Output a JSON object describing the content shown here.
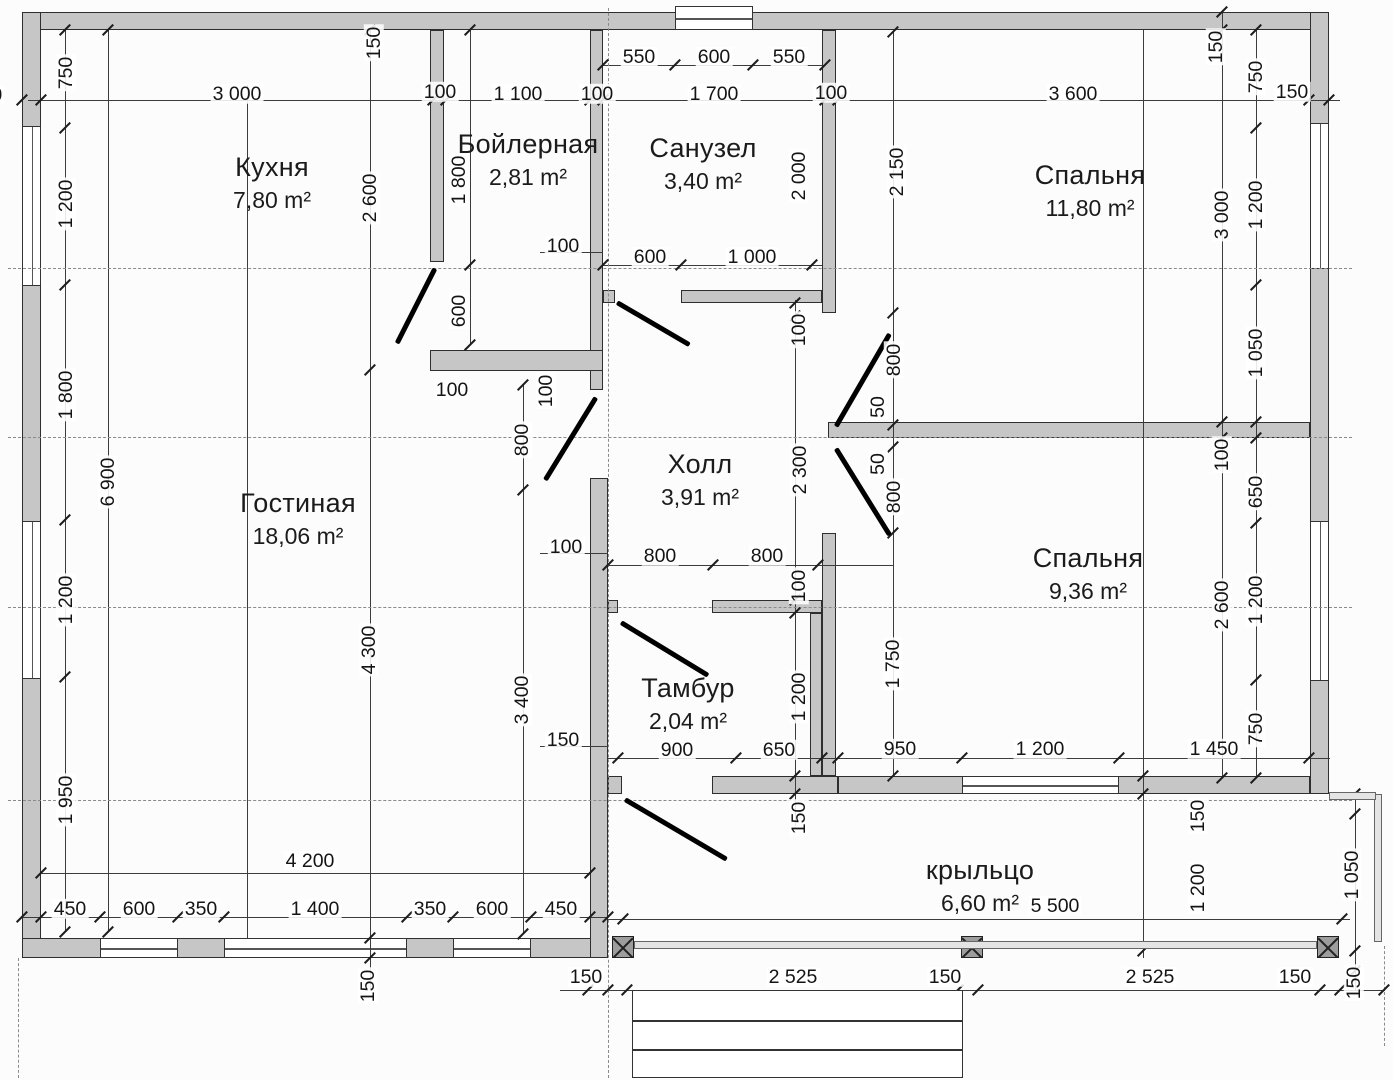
{
  "title": "План этажа (floor plan)",
  "colors": {
    "wall_fill": "#c6c6c6",
    "line": "#3c3c3c",
    "door": "#000000",
    "background": "#fcfcfc"
  },
  "rooms": [
    {
      "name": "Кухня",
      "area": "7,80 m²",
      "cx": 272,
      "cy": 183
    },
    {
      "name": "Бойлерная",
      "area": "2,81 m²",
      "cx": 528,
      "cy": 160
    },
    {
      "name": "Санузел",
      "area": "3,40 m²",
      "cx": 703,
      "cy": 164
    },
    {
      "name": "Спальня",
      "area": "11,80 m²",
      "cx": 1090,
      "cy": 191
    },
    {
      "name": "Гостиная",
      "area": "18,06 m²",
      "cx": 298,
      "cy": 519
    },
    {
      "name": "Холл",
      "area": "3,91 m²",
      "cx": 700,
      "cy": 480
    },
    {
      "name": "Спальня",
      "area": "9,36 m²",
      "cx": 1088,
      "cy": 574
    },
    {
      "name": "Тамбур",
      "area": "2,04 m²",
      "cx": 688,
      "cy": 704
    },
    {
      "name": "крыльцо",
      "area": "6,60 m²",
      "cx": 980,
      "cy": 886
    }
  ],
  "dimensions": [
    {
      "t": "150",
      "x": -14,
      "y": 95,
      "v": 0
    },
    {
      "t": "750",
      "x": 66,
      "y": 73,
      "v": 1
    },
    {
      "t": "3 000",
      "x": 237,
      "y": 94,
      "v": 0
    },
    {
      "t": "100",
      "x": 440,
      "y": 92,
      "v": 0
    },
    {
      "t": "1 100",
      "x": 518,
      "y": 94,
      "v": 0
    },
    {
      "t": "100",
      "x": 597,
      "y": 94,
      "v": 0
    },
    {
      "t": "1 700",
      "x": 714,
      "y": 94,
      "v": 0
    },
    {
      "t": "100",
      "x": 831,
      "y": 93,
      "v": 0
    },
    {
      "t": "3 600",
      "x": 1073,
      "y": 94,
      "v": 0
    },
    {
      "t": "150",
      "x": 1292,
      "y": 92,
      "v": 0
    },
    {
      "t": "150",
      "x": 374,
      "y": 43,
      "v": 1
    },
    {
      "t": "150",
      "x": 1216,
      "y": 47,
      "v": 1
    },
    {
      "t": "750",
      "x": 1256,
      "y": 77,
      "v": 1
    },
    {
      "t": "550",
      "x": 639,
      "y": 57,
      "v": 0
    },
    {
      "t": "600",
      "x": 714,
      "y": 57,
      "v": 0
    },
    {
      "t": "550",
      "x": 789,
      "y": 57,
      "v": 0
    },
    {
      "t": "1 200",
      "x": 66,
      "y": 204,
      "v": 1
    },
    {
      "t": "2 600",
      "x": 370,
      "y": 198,
      "v": 1
    },
    {
      "t": "1 800",
      "x": 459,
      "y": 180,
      "v": 1
    },
    {
      "t": "2 000",
      "x": 799,
      "y": 176,
      "v": 1
    },
    {
      "t": "2 150",
      "x": 897,
      "y": 172,
      "v": 1
    },
    {
      "t": "3 000",
      "x": 1222,
      "y": 215,
      "v": 1
    },
    {
      "t": "1 200",
      "x": 1256,
      "y": 205,
      "v": 1
    },
    {
      "t": "100",
      "x": 563,
      "y": 246,
      "v": 0
    },
    {
      "t": "600",
      "x": 650,
      "y": 257,
      "v": 0
    },
    {
      "t": "1 000",
      "x": 752,
      "y": 257,
      "v": 0
    },
    {
      "t": "600",
      "x": 459,
      "y": 311,
      "v": 1
    },
    {
      "t": "100",
      "x": 799,
      "y": 330,
      "v": 1
    },
    {
      "t": "800",
      "x": 894,
      "y": 360,
      "v": 1
    },
    {
      "t": "1 050",
      "x": 1256,
      "y": 353,
      "v": 1
    },
    {
      "t": "100",
      "x": 452,
      "y": 390,
      "v": 0
    },
    {
      "t": "100",
      "x": 546,
      "y": 391,
      "v": 1
    },
    {
      "t": "1 800",
      "x": 66,
      "y": 395,
      "v": 1
    },
    {
      "t": "6 900",
      "x": 108,
      "y": 482,
      "v": 1
    },
    {
      "t": "800",
      "x": 522,
      "y": 440,
      "v": 1
    },
    {
      "t": "2 300",
      "x": 800,
      "y": 470,
      "v": 1
    },
    {
      "t": "50",
      "x": 878,
      "y": 407,
      "v": 1
    },
    {
      "t": "50",
      "x": 878,
      "y": 464,
      "v": 1
    },
    {
      "t": "800",
      "x": 894,
      "y": 497,
      "v": 1
    },
    {
      "t": "100",
      "x": 1222,
      "y": 455,
      "v": 1
    },
    {
      "t": "650",
      "x": 1256,
      "y": 492,
      "v": 1
    },
    {
      "t": "100",
      "x": 566,
      "y": 547,
      "v": 0
    },
    {
      "t": "800",
      "x": 660,
      "y": 556,
      "v": 0
    },
    {
      "t": "800",
      "x": 767,
      "y": 556,
      "v": 0
    },
    {
      "t": "100",
      "x": 799,
      "y": 586,
      "v": 1
    },
    {
      "t": "1 200",
      "x": 66,
      "y": 600,
      "v": 1
    },
    {
      "t": "4 300",
      "x": 369,
      "y": 650,
      "v": 1
    },
    {
      "t": "3 400",
      "x": 522,
      "y": 700,
      "v": 1
    },
    {
      "t": "1 200",
      "x": 799,
      "y": 697,
      "v": 1
    },
    {
      "t": "1 750",
      "x": 893,
      "y": 664,
      "v": 1
    },
    {
      "t": "2 600",
      "x": 1222,
      "y": 605,
      "v": 1
    },
    {
      "t": "1 200",
      "x": 1256,
      "y": 600,
      "v": 1
    },
    {
      "t": "150",
      "x": 563,
      "y": 740,
      "v": 0
    },
    {
      "t": "900",
      "x": 677,
      "y": 750,
      "v": 0
    },
    {
      "t": "650",
      "x": 779,
      "y": 750,
      "v": 0
    },
    {
      "t": "150",
      "x": 799,
      "y": 818,
      "v": 1
    },
    {
      "t": "950",
      "x": 900,
      "y": 749,
      "v": 0
    },
    {
      "t": "1 200",
      "x": 1040,
      "y": 749,
      "v": 0
    },
    {
      "t": "1 450",
      "x": 1214,
      "y": 749,
      "v": 0
    },
    {
      "t": "750",
      "x": 1256,
      "y": 729,
      "v": 1
    },
    {
      "t": "150",
      "x": 1198,
      "y": 816,
      "v": 1
    },
    {
      "t": "1 200",
      "x": 1198,
      "y": 888,
      "v": 1
    },
    {
      "t": "1 050",
      "x": 1352,
      "y": 875,
      "v": 1
    },
    {
      "t": "150",
      "x": 1354,
      "y": 983,
      "v": 1
    },
    {
      "t": "1 950",
      "x": 66,
      "y": 800,
      "v": 1
    },
    {
      "t": "4 200",
      "x": 310,
      "y": 861,
      "v": 0
    },
    {
      "t": "450",
      "x": 70,
      "y": 909,
      "v": 0
    },
    {
      "t": "600",
      "x": 139,
      "y": 909,
      "v": 0
    },
    {
      "t": "350",
      "x": 201,
      "y": 909,
      "v": 0
    },
    {
      "t": "1 400",
      "x": 315,
      "y": 909,
      "v": 0
    },
    {
      "t": "350",
      "x": 430,
      "y": 909,
      "v": 0
    },
    {
      "t": "600",
      "x": 492,
      "y": 909,
      "v": 0
    },
    {
      "t": "450",
      "x": 561,
      "y": 909,
      "v": 0
    },
    {
      "t": "150",
      "x": 368,
      "y": 986,
      "v": 1
    },
    {
      "t": "150",
      "x": 586,
      "y": 977,
      "v": 0
    },
    {
      "t": "2 525",
      "x": 793,
      "y": 977,
      "v": 0
    },
    {
      "t": "150",
      "x": 945,
      "y": 977,
      "v": 0
    },
    {
      "t": "2 525",
      "x": 1150,
      "y": 977,
      "v": 0
    },
    {
      "t": "150",
      "x": 1295,
      "y": 977,
      "v": 0
    },
    {
      "t": "5 500",
      "x": 1055,
      "y": 906,
      "v": 0
    }
  ]
}
